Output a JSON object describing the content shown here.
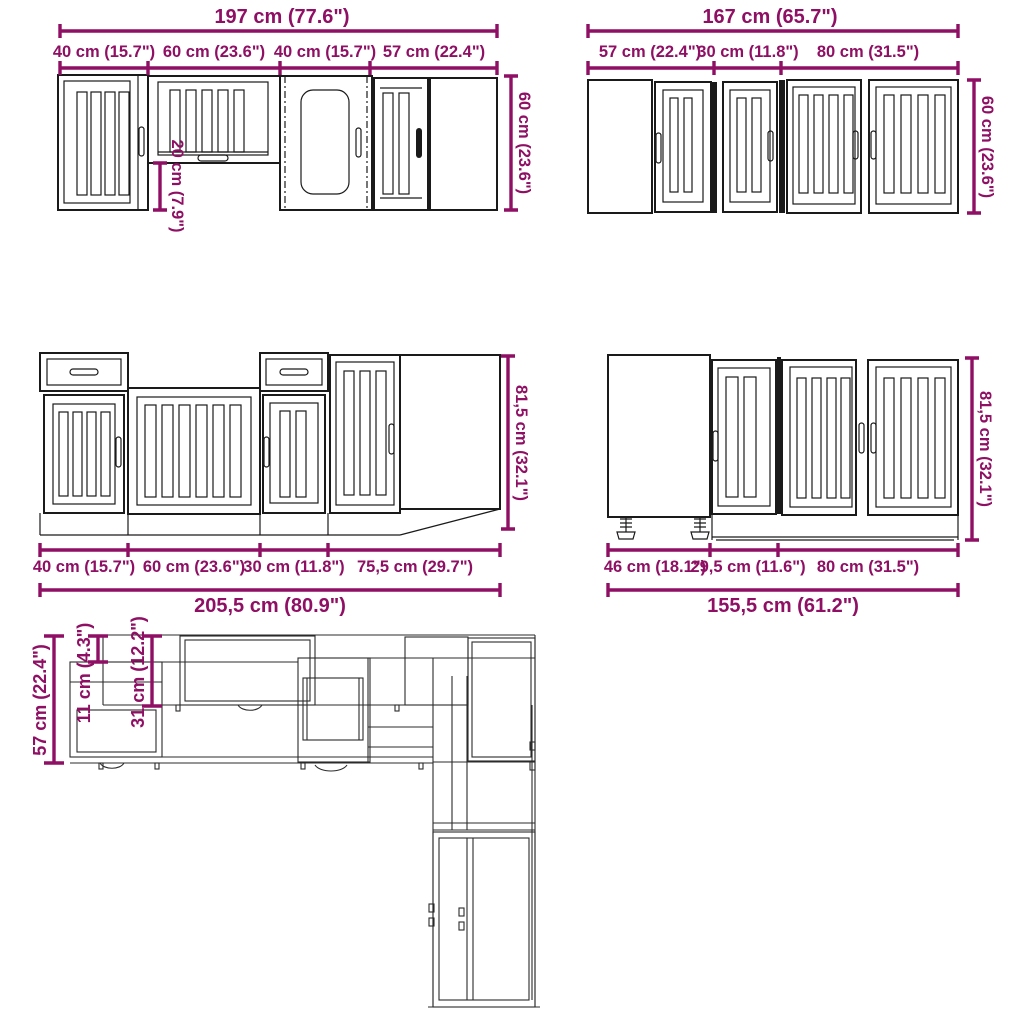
{
  "diagram": {
    "accent_color": "#8E0F63",
    "line_color": "#1a1a1a",
    "background": "#ffffff",
    "wall_row_left": {
      "total": "197 cm (77.6\")",
      "segments": [
        "40 cm (15.7\")",
        "60 cm (23.6\")",
        "40 cm (15.7\")",
        "57 cm (22.4\")"
      ],
      "height": "60 cm (23.6\")",
      "bottom_gap": "20 cm (7.9\")"
    },
    "wall_row_right": {
      "total": "167 cm (65.7\")",
      "segments": [
        "57 cm (22.4\")",
        "30 cm (11.8\")",
        "80 cm (31.5\")"
      ],
      "height": "60 cm (23.6\")"
    },
    "base_row_left": {
      "total": "205,5 cm (80.9\")",
      "segments": [
        "40 cm (15.7\")",
        "60 cm (23.6\")",
        "30 cm (11.8\")",
        "75,5 cm (29.7\")"
      ],
      "height": "81,5 cm (32.1\")"
    },
    "base_row_right": {
      "total": "155,5 cm (61.2\")",
      "segments": [
        "46 cm (18.1\")",
        "29,5 cm (11.6\")",
        "80 cm (31.5\")"
      ],
      "height": "81,5 cm (32.1\")"
    },
    "plan_view": {
      "depth_total": "57 cm (22.4\")",
      "wall_gap_depth": "11 cm (4.3\")",
      "wall_depth": "31 cm (12.2\")"
    }
  }
}
